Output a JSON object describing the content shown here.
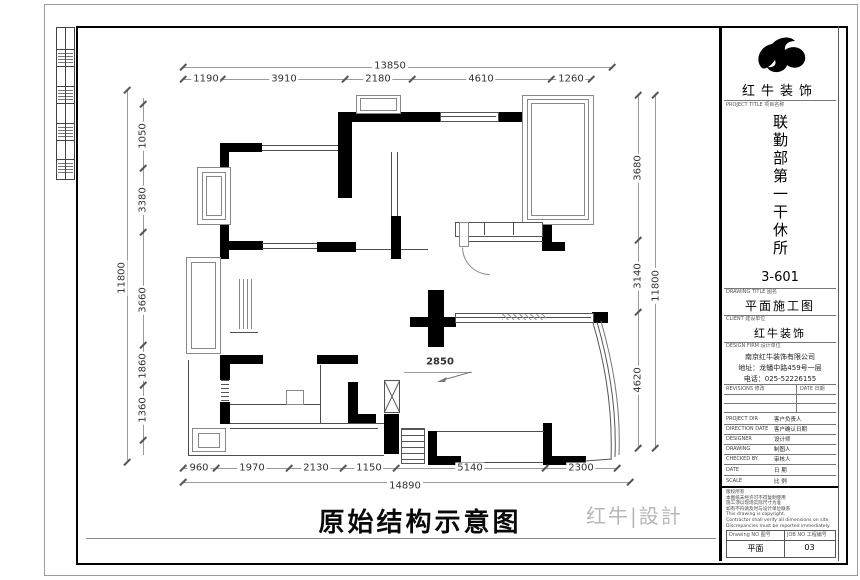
{
  "sheet": {
    "footer_title": "原始结构示意图",
    "watermark": "红牛|設計"
  },
  "dims": {
    "top": {
      "overall": "13850",
      "segments": [
        "1190",
        "3910",
        "2180",
        "4610",
        "1260"
      ]
    },
    "left": {
      "overall": "11800",
      "segments": [
        "1050",
        "3380",
        "3660",
        "1860",
        "1360"
      ]
    },
    "right": {
      "overall": "11800",
      "segments": [
        "3680",
        "3140",
        "4620"
      ]
    },
    "bottom": {
      "overall": "14890",
      "segments": [
        "960",
        "1970",
        "2130",
        "1150",
        "5140",
        "2300"
      ]
    },
    "interior_span": "2850"
  },
  "title_block": {
    "brand": "红牛装饰",
    "section_labels": {
      "project": "PROJECT TITLE 项目名称",
      "drawing_title": "DRAWING TITLE 图名",
      "client": "CLIENT 建设单位",
      "firm": "DESIGN FIRM 设计单位"
    },
    "project_name_vertical": "联勤部第一干休所",
    "unit_no": "3-601",
    "drawing_title": "平面施工图",
    "client_name": "红牛装饰",
    "firm_lines": [
      "南京红牛装饰有限公司",
      "地址：龙蟠中路459号一层",
      "电话：025-52226155"
    ],
    "revisions": {
      "col1": "REVISIONS 修改",
      "col2": "DATE 日期"
    },
    "rows": [
      {
        "label": "PROJECT DIR",
        "value": "客户负责人"
      },
      {
        "label": "DIRECTION DATE",
        "value": "客户确认日期"
      },
      {
        "label": "DESIGNER",
        "value": "设计师"
      },
      {
        "label": "DRAWING",
        "value": "制图人"
      },
      {
        "label": "CHECKED BY",
        "value": "审核人"
      },
      {
        "label": "DATE",
        "value": "日 期"
      },
      {
        "label": "SCALE",
        "value": "比 例"
      }
    ],
    "notes": [
      "版权所有",
      "本图纸未经许可不得复制使用",
      "施工须以现场实际尺寸为准",
      "如有不符请及时与设计单位联系",
      "This drawing is copyright.",
      "Contractor shall verify all dimensions on site.",
      "Discrepancies must be reported immediately."
    ],
    "drawing_no": {
      "label": "Drawing NO 图号",
      "value": "平面"
    },
    "job_no": {
      "label": "JOB NO 工程编号",
      "value": "03"
    }
  }
}
